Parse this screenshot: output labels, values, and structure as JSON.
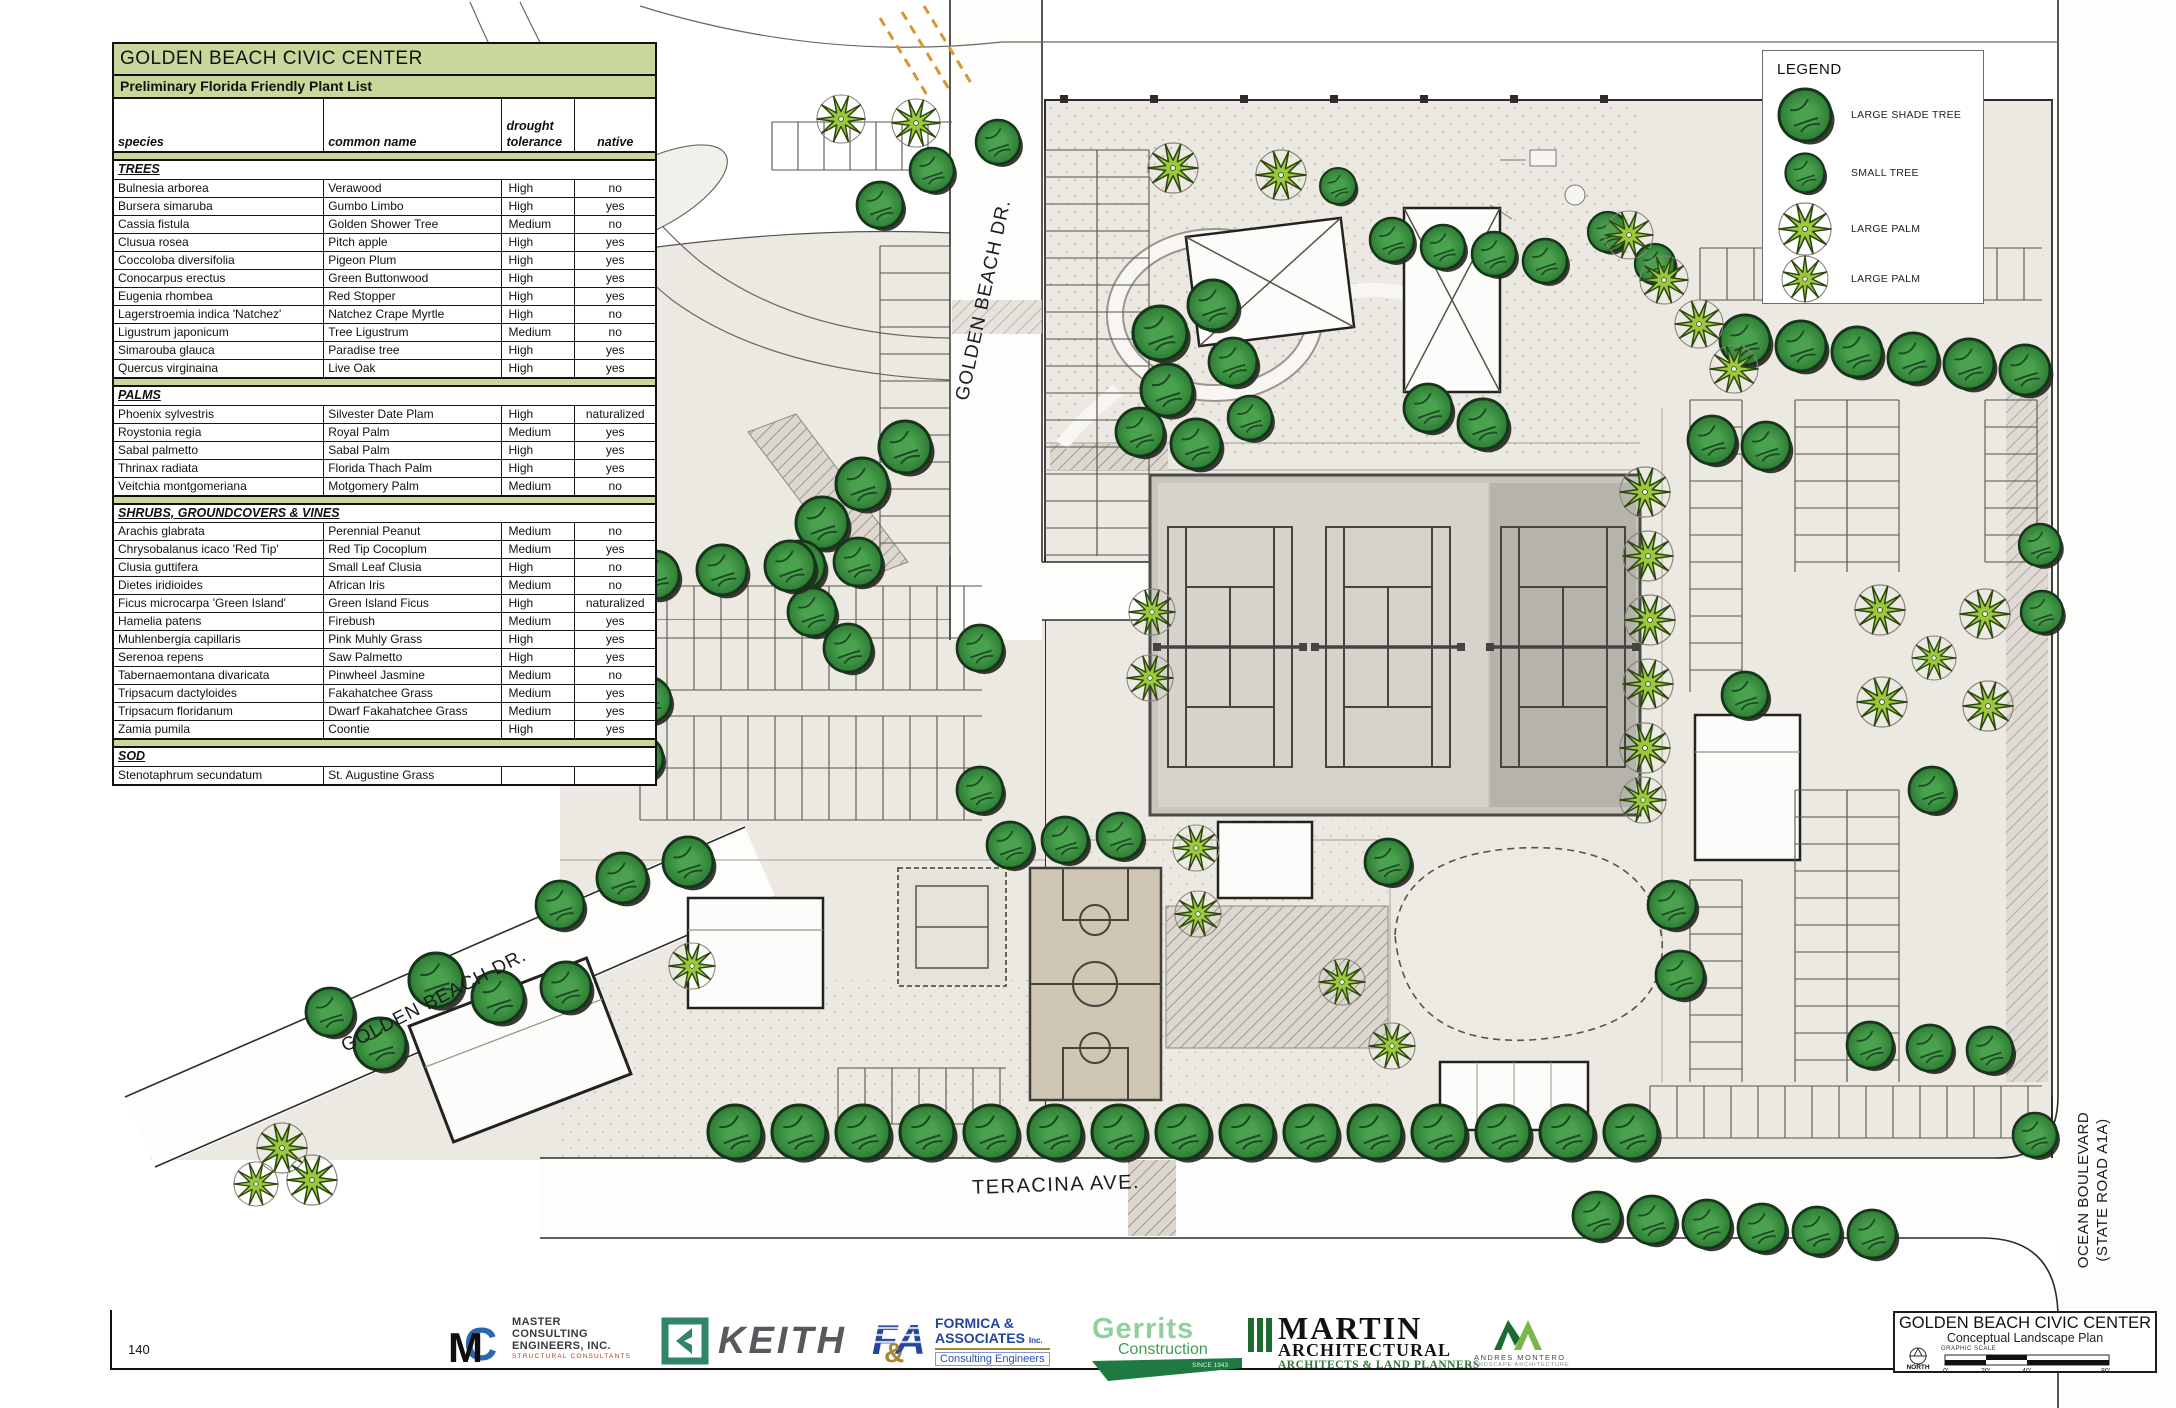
{
  "page_number": "140",
  "colors": {
    "table_header_green": "#c9d79c",
    "tree_green": "#3e9144",
    "palm_green": "#9cc83e",
    "ground": "#ebe9e2"
  },
  "plant_list": {
    "title": "GOLDEN BEACH CIVIC CENTER",
    "subtitle": "Preliminary Florida Friendly Plant List",
    "col_species": "species",
    "col_common": "common name",
    "col_drought_line1": "drought",
    "col_drought_line2": "tolerance",
    "col_native": "native",
    "sections": [
      {
        "name": "TREES",
        "rows": [
          [
            "Bulnesia arborea",
            "Verawood",
            "High",
            "no"
          ],
          [
            "Bursera simaruba",
            "Gumbo Limbo",
            "High",
            "yes"
          ],
          [
            "Cassia fistula",
            "Golden Shower Tree",
            "Medium",
            "no"
          ],
          [
            "Clusua rosea",
            "Pitch apple",
            "High",
            "yes"
          ],
          [
            "Coccoloba diversifolia",
            "Pigeon Plum",
            "High",
            "yes"
          ],
          [
            "Conocarpus erectus",
            "Green Buttonwood",
            "High",
            "yes"
          ],
          [
            "Eugenia rhombea",
            "Red Stopper",
            "High",
            "yes"
          ],
          [
            "Lagerstroemia indica 'Natchez'",
            "Natchez Crape Myrtle",
            "High",
            "no"
          ],
          [
            "Ligustrum japonicum",
            "Tree Ligustrum",
            "Medium",
            "no"
          ],
          [
            "Simarouba glauca",
            "Paradise tree",
            "High",
            "yes"
          ],
          [
            "Quercus virginaina",
            "Live Oak",
            "High",
            "yes"
          ]
        ]
      },
      {
        "name": "PALMS",
        "rows": [
          [
            "Phoenix sylvestris",
            "Silvester Date Plam",
            "High",
            "naturalized"
          ],
          [
            "Roystonia regia",
            "Royal Palm",
            "Medium",
            "yes"
          ],
          [
            "Sabal palmetto",
            "Sabal Palm",
            "High",
            "yes"
          ],
          [
            "Thrinax radiata",
            "Florida Thach Palm",
            "High",
            "yes"
          ],
          [
            "Veitchia montgomeriana",
            "Motgomery Palm",
            "Medium",
            "no"
          ]
        ]
      },
      {
        "name": "SHRUBS, GROUNDCOVERS & VINES",
        "rows": [
          [
            "Arachis glabrata",
            "Perennial Peanut",
            "Medium",
            "no"
          ],
          [
            "Chrysobalanus icaco 'Red Tip'",
            "Red Tip Cocoplum",
            "Medium",
            "yes"
          ],
          [
            "Clusia guttifera",
            "Small Leaf Clusia",
            "High",
            "no"
          ],
          [
            "Dietes iridioides",
            "African Iris",
            "Medium",
            "no"
          ],
          [
            "Ficus microcarpa 'Green Island'",
            "Green Island Ficus",
            "High",
            "naturalized"
          ],
          [
            "Hamelia patens",
            "Firebush",
            "Medium",
            "yes"
          ],
          [
            "Muhlenbergia capillaris",
            "Pink Muhly Grass",
            "High",
            "yes"
          ],
          [
            "Serenoa repens",
            "Saw Palmetto",
            "High",
            "yes"
          ],
          [
            "Tabernaemontana divaricata",
            "Pinwheel Jasmine",
            "Medium",
            "no"
          ],
          [
            "Tripsacum dactyloides",
            "Fakahatchee Grass",
            "Medium",
            "yes"
          ],
          [
            "Tripsacum floridanum",
            "Dwarf Fakahatchee Grass",
            "Medium",
            "yes"
          ],
          [
            "Zamia pumila",
            "Coontie",
            "High",
            "yes"
          ]
        ]
      },
      {
        "name": "SOD",
        "rows": [
          [
            "Stenotaphrum secundatum",
            "St. Augustine Grass",
            "",
            ""
          ]
        ]
      }
    ]
  },
  "legend": {
    "title": "LEGEND",
    "items": [
      {
        "icon": "large-shade-tree",
        "label": "LARGE SHADE TREE"
      },
      {
        "icon": "small-tree",
        "label": "SMALL TREE"
      },
      {
        "icon": "large-palm",
        "label": "LARGE PALM"
      },
      {
        "icon": "large-palm",
        "label": "LARGE PALM"
      }
    ]
  },
  "streets": {
    "golden_beach_dr_top": "GOLDEN BEACH DR.",
    "golden_beach_dr_sw": "GOLDEN BEACH DR.",
    "teracina": "TERACINA AVE.",
    "ocean_blvd_1": "OCEAN BOULEVARD",
    "ocean_blvd_2": "(STATE ROAD A1A)"
  },
  "title_block": {
    "title": "GOLDEN BEACH CIVIC CENTER",
    "subtitle": "Conceptual Landscape Plan",
    "graphic_scale": "GRAPHIC SCALE",
    "north": "NORTH",
    "scale_ticks": [
      "0'",
      "20'",
      "40'",
      "80'"
    ]
  },
  "logos": {
    "master": {
      "line1": "MASTER",
      "line2": "CONSULTING",
      "line3": "ENGINEERS, INC.",
      "tagline": "STRUCTURAL CONSULTANTS"
    },
    "keith": {
      "word": "KEITH"
    },
    "formica": {
      "line1": "FORMICA &",
      "line2": "ASSOCIATES",
      "inc": "Inc.",
      "tagline": "Consulting Engineers"
    },
    "gerrits": {
      "line1": "Gerrits",
      "line2": "Construction",
      "tagline": "SINCE 1943"
    },
    "martin": {
      "line1": "MARTIN",
      "line2": "ARCHITECTURAL",
      "tagline": "ARCHITECTS & LAND PLANNERS"
    },
    "andres": {
      "line1": "ANDRES MONTERO",
      "line2": "LANDSCAPE ARCHITECTURE"
    }
  },
  "plan": {
    "trees": [
      [
        1160,
        333,
        27
      ],
      [
        1213,
        305,
        25
      ],
      [
        1167,
        390,
        26
      ],
      [
        1233,
        362,
        24
      ],
      [
        1140,
        432,
        24
      ],
      [
        1196,
        444,
        25
      ],
      [
        1250,
        418,
        22
      ],
      [
        1428,
        408,
        24
      ],
      [
        1483,
        424,
        25
      ],
      [
        1608,
        232,
        20
      ],
      [
        1655,
        264,
        20
      ],
      [
        1338,
        186,
        18
      ],
      [
        1392,
        240,
        22
      ],
      [
        1443,
        247,
        22
      ],
      [
        1494,
        254,
        22
      ],
      [
        1545,
        261,
        22
      ],
      [
        1745,
        340,
        25
      ],
      [
        1801,
        346,
        25
      ],
      [
        1857,
        352,
        25
      ],
      [
        1913,
        358,
        25
      ],
      [
        1969,
        364,
        25
      ],
      [
        2025,
        370,
        25
      ],
      [
        1712,
        440,
        24
      ],
      [
        1766,
        446,
        24
      ],
      [
        2040,
        545,
        21
      ],
      [
        2042,
        612,
        21
      ],
      [
        905,
        447,
        26
      ],
      [
        862,
        484,
        26
      ],
      [
        822,
        523,
        26
      ],
      [
        800,
        566,
        25
      ],
      [
        812,
        612,
        24
      ],
      [
        848,
        648,
        24
      ],
      [
        655,
        575,
        24
      ],
      [
        722,
        570,
        25
      ],
      [
        790,
        566,
        25
      ],
      [
        858,
        562,
        24
      ],
      [
        648,
        700,
        23
      ],
      [
        980,
        648,
        23
      ],
      [
        980,
        790,
        23
      ],
      [
        640,
        758,
        23
      ],
      [
        436,
        980,
        27
      ],
      [
        498,
        997,
        26
      ],
      [
        380,
        1044,
        26
      ],
      [
        330,
        1012,
        24
      ],
      [
        566,
        987,
        25
      ],
      [
        560,
        905,
        24
      ],
      [
        622,
        878,
        25
      ],
      [
        688,
        862,
        25
      ],
      [
        1010,
        845,
        23
      ],
      [
        1065,
        840,
        23
      ],
      [
        1120,
        836,
        23
      ],
      [
        735,
        1132,
        27
      ],
      [
        799,
        1132,
        27
      ],
      [
        863,
        1132,
        27
      ],
      [
        927,
        1132,
        27
      ],
      [
        991,
        1132,
        27
      ],
      [
        1055,
        1132,
        27
      ],
      [
        1119,
        1132,
        27
      ],
      [
        1183,
        1132,
        27
      ],
      [
        1247,
        1132,
        27
      ],
      [
        1311,
        1132,
        27
      ],
      [
        1375,
        1132,
        27
      ],
      [
        1439,
        1132,
        27
      ],
      [
        1503,
        1132,
        27
      ],
      [
        1567,
        1132,
        27
      ],
      [
        1631,
        1132,
        27
      ],
      [
        1597,
        1216,
        24
      ],
      [
        1652,
        1220,
        24
      ],
      [
        1707,
        1224,
        24
      ],
      [
        1762,
        1228,
        24
      ],
      [
        1817,
        1231,
        24
      ],
      [
        1872,
        1234,
        24
      ],
      [
        1672,
        905,
        24
      ],
      [
        1680,
        975,
        24
      ],
      [
        1388,
        862,
        23
      ],
      [
        1745,
        695,
        23
      ],
      [
        1932,
        790,
        23
      ],
      [
        1870,
        1045,
        23
      ],
      [
        1930,
        1048,
        23
      ],
      [
        1990,
        1050,
        23
      ],
      [
        2035,
        1135,
        22
      ],
      [
        880,
        205,
        23
      ],
      [
        932,
        170,
        22
      ],
      [
        998,
        142,
        22
      ]
    ],
    "palms": [
      [
        841,
        119,
        24
      ],
      [
        916,
        123,
        24
      ],
      [
        1173,
        168,
        25
      ],
      [
        1281,
        175,
        25
      ],
      [
        1629,
        235,
        24
      ],
      [
        1664,
        280,
        24
      ],
      [
        1699,
        324,
        24
      ],
      [
        1734,
        369,
        24
      ],
      [
        1645,
        492,
        25
      ],
      [
        1648,
        556,
        25
      ],
      [
        1650,
        620,
        25
      ],
      [
        1648,
        684,
        25
      ],
      [
        1645,
        748,
        25
      ],
      [
        1643,
        800,
        23
      ],
      [
        1152,
        612,
        23
      ],
      [
        1150,
        678,
        23
      ],
      [
        1196,
        848,
        23
      ],
      [
        1198,
        914,
        23
      ],
      [
        1342,
        982,
        23
      ],
      [
        1392,
        1046,
        23
      ],
      [
        1880,
        610,
        25
      ],
      [
        1985,
        614,
        25
      ],
      [
        1882,
        702,
        25
      ],
      [
        1988,
        706,
        25
      ],
      [
        1934,
        658,
        22
      ],
      [
        282,
        1148,
        25
      ],
      [
        312,
        1180,
        25
      ],
      [
        256,
        1184,
        22
      ],
      [
        692,
        966,
        23
      ]
    ],
    "parking": [
      [
        "v",
        1045,
        150,
        556,
        52,
        27
      ],
      [
        "v",
        1097,
        150,
        556,
        52,
        27
      ],
      [
        "v",
        880,
        246,
        556,
        70,
        27
      ],
      [
        "h",
        586,
        640,
        982,
        52,
        27
      ],
      [
        "h",
        638,
        640,
        982,
        52,
        27
      ],
      [
        "h",
        716,
        640,
        982,
        52,
        27
      ],
      [
        "h",
        768,
        640,
        982,
        52,
        27
      ],
      [
        "h",
        1068,
        838,
        1006,
        56,
        27
      ],
      [
        "v",
        1690,
        400,
        692,
        52,
        27
      ],
      [
        "v",
        1690,
        880,
        1082,
        52,
        27
      ],
      [
        "v",
        1795,
        400,
        572,
        52,
        27
      ],
      [
        "v",
        1847,
        400,
        572,
        52,
        27
      ],
      [
        "v",
        1795,
        790,
        1082,
        52,
        27
      ],
      [
        "v",
        1847,
        790,
        1082,
        52,
        27
      ],
      [
        "v",
        1985,
        400,
        562,
        52,
        27
      ],
      [
        "h",
        248,
        1700,
        2042,
        52,
        27
      ],
      [
        "h",
        1086,
        1650,
        2042,
        52,
        27
      ],
      [
        "h",
        122,
        772,
        952,
        48,
        26
      ]
    ]
  }
}
